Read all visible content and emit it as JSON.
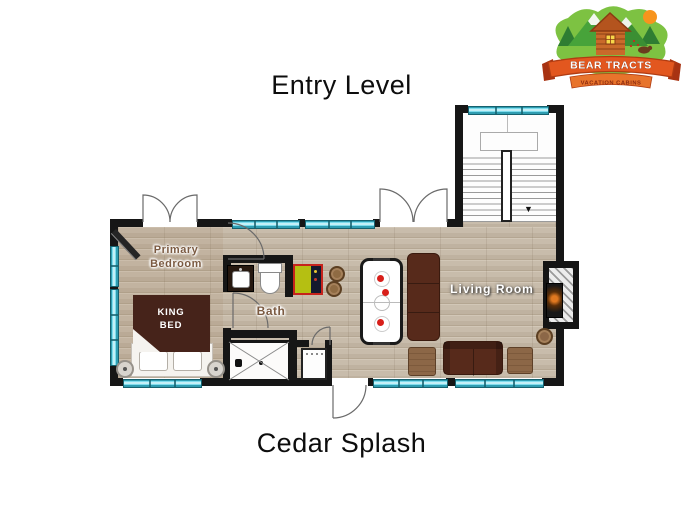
{
  "header": {
    "title": "Entry Level"
  },
  "footer": {
    "plan_name": "Cedar Splash"
  },
  "logo": {
    "name": "BEAR TRACTS",
    "tagline": "VACATION CABINS"
  },
  "rooms": {
    "primary_bedroom": {
      "label": "Primary Bedroom"
    },
    "bath": {
      "label": "Bath"
    },
    "living_room": {
      "label": "Living Room"
    }
  },
  "furniture": {
    "king_bed": {
      "label": "KING BED"
    }
  },
  "stairs": {
    "direction_icon": "▼"
  },
  "colors": {
    "wall": "#161616",
    "window_teal": "#4cc3d7",
    "floor_wood": "#c8bcab",
    "bed_brown": "#46231a",
    "sofa_brown": "#572a1b",
    "wood_accent": "#8c6747",
    "game_table_green": "#b5bf12",
    "accent_red": "#d22f27",
    "logo_green": "#7dc242",
    "banner_orange": "#e2571f"
  }
}
